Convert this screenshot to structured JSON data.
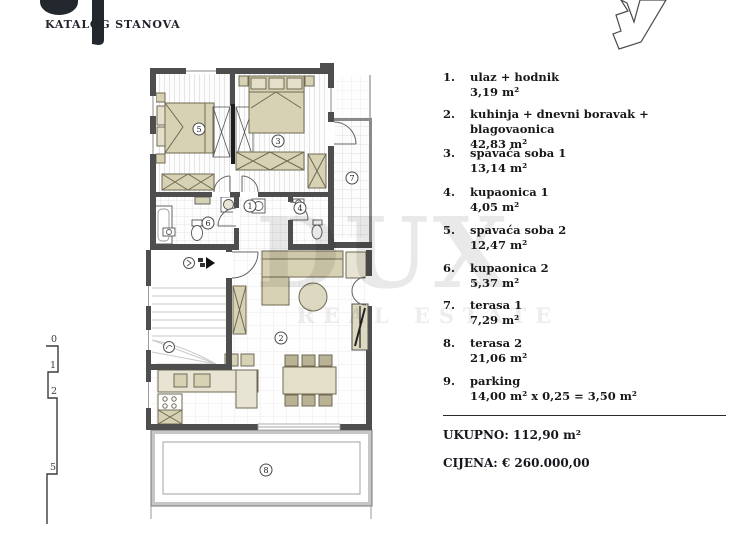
{
  "header": {
    "title": "KATALOG STANOVA"
  },
  "watermark": {
    "line1": "DUX",
    "line2": "REAL ESTATE"
  },
  "legend": {
    "items": [
      {
        "no": "1.",
        "label": "ulaz + hodnik",
        "area": "3,19 m²"
      },
      {
        "no": "2.",
        "label": "kuhinja + dnevni boravak + blagovaonica",
        "area": "42,83 m²"
      },
      {
        "no": "3.",
        "label": "spavaća soba 1",
        "area": "13,14 m²"
      },
      {
        "no": "4.",
        "label": "kupaonica 1",
        "area": "4,05 m²"
      },
      {
        "no": "5.",
        "label": "spavaća soba 2",
        "area": "12,47 m²"
      },
      {
        "no": "6.",
        "label": "kupaonica 2",
        "area": "5,37 m²"
      },
      {
        "no": "7.",
        "label": "terasa 1",
        "area": "7,29 m²"
      },
      {
        "no": "8.",
        "label": "terasa 2",
        "area": "21,06 m²"
      },
      {
        "no": "9.",
        "label": "parking",
        "area": "14,00 m² x 0,25 = 3,50 m²"
      }
    ],
    "total_label": "UKUPNO: 112,90 m²",
    "price_label": "CIJENA: € 260.000,00"
  },
  "plan": {
    "room_labels": [
      "1",
      "2",
      "3",
      "4",
      "5",
      "6",
      "7",
      "8"
    ]
  },
  "scale": {
    "marks": [
      "0",
      "1",
      "2",
      "5"
    ]
  },
  "colors": {
    "wall": "#4e4e4e",
    "furniture": "#d8d2b4",
    "logo": "#23272e"
  }
}
